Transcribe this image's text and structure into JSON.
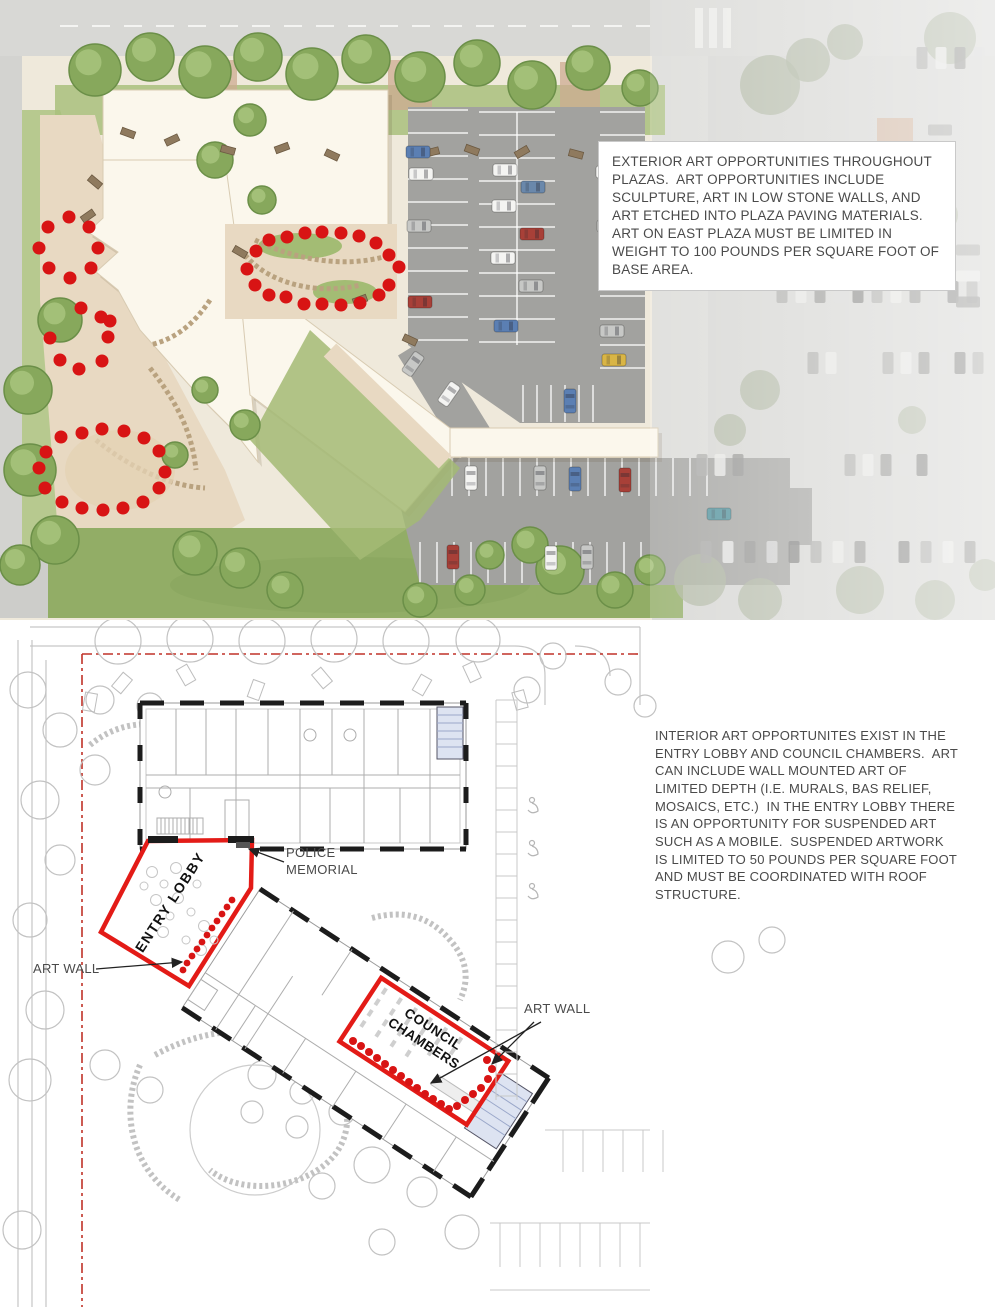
{
  "page": {
    "width": 995,
    "height": 1307
  },
  "colors": {
    "accent_red": "#e31b17",
    "dot_red": "#d81414",
    "building": "#fbf7ec",
    "parking": "#a2a29f",
    "cars": {
      "blue": "#5b7fb3",
      "blue2": "#6a88ab",
      "white": "#f4f4f2",
      "silver": "#c7c8c6",
      "red": "#a84038",
      "yellow": "#d9b545",
      "teal": "#4d8f99"
    }
  },
  "top_panel": {
    "note_text": "EXTERIOR ART OPPORTUNITIES THROUGHOUT PLAZAS.  ART OPPORTUNITIES INCLUDE SCULPTURE, ART IN LOW STONE WALLS, AND ART ETCHED INTO PLAZA PAVING MATERIALS.  ART ON EAST PLAZA MUST BE LIMITED IN WEIGHT TO 100 POUNDS PER SQUARE FOOT OF BASE AREA.",
    "art_dots": {
      "west_walk": [
        [
          69,
          217
        ],
        [
          48,
          227
        ],
        [
          89,
          227
        ],
        [
          39,
          248
        ],
        [
          98,
          248
        ],
        [
          49,
          268
        ],
        [
          91,
          268
        ],
        [
          70,
          278
        ],
        [
          81,
          308
        ],
        [
          101,
          317
        ],
        [
          61,
          437
        ],
        [
          46,
          452
        ],
        [
          39,
          468
        ],
        [
          45,
          488
        ],
        [
          62,
          502
        ]
      ],
      "courtyard": [
        [
          256,
          251
        ],
        [
          269,
          240
        ],
        [
          287,
          237
        ],
        [
          305,
          233
        ],
        [
          322,
          232
        ],
        [
          341,
          233
        ],
        [
          359,
          236
        ],
        [
          376,
          243
        ],
        [
          389,
          255
        ],
        [
          399,
          267
        ],
        [
          389,
          285
        ],
        [
          379,
          295
        ],
        [
          247,
          269
        ],
        [
          255,
          285
        ],
        [
          269,
          295
        ],
        [
          286,
          297
        ],
        [
          304,
          304
        ],
        [
          322,
          304
        ],
        [
          341,
          305
        ],
        [
          360,
          303
        ]
      ],
      "garden_ring": [
        [
          82,
          433
        ],
        [
          102,
          429
        ],
        [
          124,
          431
        ],
        [
          144,
          438
        ],
        [
          159,
          451
        ],
        [
          165,
          472
        ],
        [
          159,
          488
        ],
        [
          143,
          502
        ],
        [
          123,
          508
        ],
        [
          103,
          510
        ],
        [
          82,
          508
        ]
      ],
      "garden_arc": [
        [
          50,
          338
        ],
        [
          60,
          360
        ],
        [
          79,
          369
        ],
        [
          102,
          361
        ],
        [
          108,
          337
        ],
        [
          110,
          321
        ]
      ]
    },
    "trees": {
      "rendered": [
        [
          95,
          70,
          26
        ],
        [
          150,
          57,
          24
        ],
        [
          205,
          72,
          26
        ],
        [
          258,
          57,
          24
        ],
        [
          312,
          74,
          26
        ],
        [
          366,
          59,
          24
        ],
        [
          420,
          77,
          25
        ],
        [
          477,
          63,
          23
        ],
        [
          532,
          85,
          24
        ],
        [
          588,
          68,
          22
        ],
        [
          640,
          88,
          18
        ],
        [
          250,
          120,
          16
        ],
        [
          215,
          160,
          18
        ],
        [
          262,
          200,
          14
        ],
        [
          60,
          320,
          22
        ],
        [
          28,
          390,
          24
        ],
        [
          30,
          470,
          26
        ],
        [
          55,
          540,
          24
        ],
        [
          20,
          565,
          20
        ],
        [
          195,
          553,
          22
        ],
        [
          240,
          568,
          20
        ],
        [
          285,
          590,
          18
        ],
        [
          420,
          600,
          17
        ],
        [
          470,
          590,
          15
        ],
        [
          560,
          570,
          24
        ],
        [
          615,
          590,
          18
        ],
        [
          650,
          570,
          15
        ],
        [
          530,
          545,
          18
        ],
        [
          490,
          555,
          14
        ],
        [
          245,
          425,
          15
        ],
        [
          205,
          390,
          13
        ],
        [
          175,
          455,
          13
        ]
      ],
      "faded": [
        [
          770,
          85,
          30
        ],
        [
          808,
          60,
          22
        ],
        [
          845,
          42,
          18
        ],
        [
          950,
          38,
          26
        ],
        [
          900,
          185,
          22
        ],
        [
          940,
          215,
          18
        ],
        [
          855,
          240,
          14
        ],
        [
          760,
          390,
          20
        ],
        [
          730,
          430,
          16
        ],
        [
          912,
          420,
          14
        ],
        [
          700,
          580,
          26
        ],
        [
          760,
          600,
          22
        ],
        [
          860,
          590,
          24
        ],
        [
          935,
          600,
          20
        ],
        [
          985,
          575,
          16
        ]
      ]
    },
    "benches": [
      [
        128,
        133,
        20
      ],
      [
        172,
        140,
        -25
      ],
      [
        228,
        150,
        15
      ],
      [
        282,
        148,
        -20
      ],
      [
        332,
        155,
        25
      ],
      [
        432,
        152,
        -15
      ],
      [
        472,
        150,
        20
      ],
      [
        522,
        152,
        -30
      ],
      [
        576,
        154,
        15
      ],
      [
        620,
        150,
        -20
      ],
      [
        95,
        182,
        40
      ],
      [
        88,
        216,
        -35
      ],
      [
        240,
        252,
        30
      ],
      [
        360,
        300,
        -20
      ],
      [
        410,
        340,
        25
      ]
    ],
    "cars": [
      [
        418,
        152,
        90,
        "blue"
      ],
      [
        421,
        174,
        90,
        "white"
      ],
      [
        419,
        226,
        90,
        "silver"
      ],
      [
        420,
        302,
        90,
        "red"
      ],
      [
        505,
        170,
        90,
        "white"
      ],
      [
        533,
        187,
        90,
        "blue2"
      ],
      [
        504,
        206,
        90,
        "white"
      ],
      [
        532,
        234,
        90,
        "red"
      ],
      [
        503,
        258,
        90,
        "white"
      ],
      [
        531,
        286,
        90,
        "silver"
      ],
      [
        506,
        326,
        90,
        "blue"
      ],
      [
        608,
        172,
        90,
        "white"
      ],
      [
        609,
        226,
        90,
        "silver"
      ],
      [
        612,
        331,
        90,
        "silver"
      ],
      [
        614,
        360,
        90,
        "yellow"
      ],
      [
        570,
        401,
        0,
        "blue"
      ],
      [
        413,
        364,
        35,
        "silver"
      ],
      [
        449,
        394,
        35,
        "white"
      ],
      [
        471,
        478,
        0,
        "white"
      ],
      [
        540,
        478,
        0,
        "silver"
      ],
      [
        575,
        479,
        0,
        "blue"
      ],
      [
        625,
        480,
        0,
        "red"
      ],
      [
        719,
        514,
        90,
        "teal"
      ],
      [
        453,
        557,
        0,
        "red"
      ],
      [
        551,
        558,
        0,
        "white"
      ],
      [
        587,
        557,
        0,
        "silver"
      ]
    ],
    "faded_car_rows": [
      {
        "x": 782,
        "y": 292,
        "n": 11,
        "dx": 19,
        "dy": 0
      },
      {
        "x": 888,
        "y": 363,
        "n": 6,
        "dx": 18,
        "dy": 0
      },
      {
        "x": 922,
        "y": 58,
        "n": 4,
        "dx": 19,
        "dy": 0
      },
      {
        "x": 813,
        "y": 363,
        "n": 2,
        "dx": 18,
        "dy": 0
      },
      {
        "x": 702,
        "y": 465,
        "n": 3,
        "dx": 18,
        "dy": 0
      },
      {
        "x": 850,
        "y": 465,
        "n": 5,
        "dx": 18,
        "dy": 0
      },
      {
        "x": 706,
        "y": 552,
        "n": 13,
        "dx": 22,
        "dy": 0
      },
      {
        "x": 940,
        "y": 130,
        "n": 3,
        "dx": 0,
        "dy": 26
      },
      {
        "x": 968,
        "y": 250,
        "n": 4,
        "dx": 0,
        "dy": 26
      }
    ]
  },
  "bottom_panel": {
    "note_text": "INTERIOR ART OPPORTUNITES EXIST IN THE ENTRY LOBBY AND COUNCIL CHAMBERS.  ART CAN INCLUDE WALL MOUNTED ART OF LIMITED DEPTH (I.E. MURALS, BAS RELIEF, MOSAICS, ETC.)  IN THE ENTRY LOBBY THERE IS AN OPPORTUNITY FOR SUSPENDED ART SUCH AS A MOBILE.  SUSPENDED ARTWORK IS LIMITED TO 50 POUNDS PER SQUARE FOOT AND MUST BE COORDINATED WITH ROOF STRUCTURE.",
    "labels": {
      "entry_lobby": "ENTRY LOBBY",
      "council_chambers": "COUNCIL CHAMBERS",
      "police_memorial": "POLICE MEMORIAL",
      "art_wall": "ART WALL"
    },
    "art_dots": {
      "entry_lobby": [
        [
          232,
          900
        ],
        [
          227,
          907
        ],
        [
          222,
          914
        ],
        [
          217,
          921
        ],
        [
          212,
          928
        ],
        [
          207,
          935
        ],
        [
          202,
          942
        ],
        [
          197,
          949
        ],
        [
          192,
          956
        ],
        [
          187,
          963
        ],
        [
          183,
          970
        ]
      ],
      "council_chambers": [
        [
          353,
          1041
        ],
        [
          361,
          1046
        ],
        [
          369,
          1052
        ],
        [
          377,
          1058
        ],
        [
          385,
          1064
        ],
        [
          393,
          1070
        ],
        [
          401,
          1076
        ],
        [
          409,
          1082
        ],
        [
          417,
          1088
        ],
        [
          425,
          1094
        ],
        [
          433,
          1099
        ],
        [
          441,
          1104
        ],
        [
          449,
          1109
        ],
        [
          457,
          1106
        ],
        [
          465,
          1100
        ],
        [
          473,
          1094
        ],
        [
          481,
          1088
        ],
        [
          488,
          1079
        ],
        [
          492,
          1069
        ],
        [
          487,
          1060
        ]
      ]
    },
    "trees": [
      [
        118,
        641,
        23
      ],
      [
        190,
        639,
        23
      ],
      [
        262,
        641,
        23
      ],
      [
        334,
        639,
        23
      ],
      [
        406,
        641,
        23
      ],
      [
        478,
        640,
        22
      ],
      [
        553,
        656,
        13
      ],
      [
        527,
        690,
        13
      ],
      [
        618,
        682,
        13
      ],
      [
        100,
        700,
        14
      ],
      [
        150,
        706,
        13
      ],
      [
        60,
        730,
        17
      ],
      [
        95,
        770,
        15
      ],
      [
        40,
        800,
        19
      ],
      [
        170,
        790,
        12
      ],
      [
        60,
        860,
        15
      ],
      [
        30,
        920,
        17
      ],
      [
        45,
        1010,
        19
      ],
      [
        30,
        1080,
        21
      ],
      [
        105,
        1065,
        15
      ],
      [
        150,
        1090,
        13
      ],
      [
        262,
        1075,
        14
      ],
      [
        302,
        1092,
        12
      ],
      [
        342,
        1112,
        13
      ],
      [
        252,
        1112,
        11
      ],
      [
        297,
        1127,
        11
      ],
      [
        372,
        1165,
        18
      ],
      [
        422,
        1192,
        15
      ],
      [
        322,
        1186,
        13
      ],
      [
        462,
        1232,
        17
      ],
      [
        382,
        1242,
        13
      ],
      [
        728,
        957,
        16
      ],
      [
        772,
        940,
        13
      ],
      [
        645,
        706,
        11
      ],
      [
        28,
        690,
        18
      ],
      [
        22,
        1230,
        19
      ]
    ],
    "deck_benches": [
      [
        122,
        683,
        40
      ],
      [
        186,
        675,
        -30
      ],
      [
        256,
        690,
        20
      ],
      [
        322,
        678,
        -40
      ],
      [
        422,
        685,
        30
      ],
      [
        472,
        672,
        -25
      ],
      [
        90,
        702,
        10
      ],
      [
        520,
        700,
        -15
      ]
    ],
    "entry_furniture": [
      [
        152,
        872
      ],
      [
        164,
        884
      ],
      [
        178,
        898
      ],
      [
        191,
        912
      ],
      [
        204,
        926
      ],
      [
        170,
        916
      ],
      [
        156,
        900
      ],
      [
        186,
        940
      ],
      [
        201,
        950
      ],
      [
        214,
        940
      ],
      [
        163,
        932
      ],
      [
        144,
        886
      ],
      [
        176,
        868
      ],
      [
        197,
        884
      ]
    ],
    "stall_lines": [
      {
        "o": "h",
        "x": 496,
        "y": 700,
        "len": 21,
        "step": 22,
        "n": 19
      },
      {
        "o": "v",
        "x": 563,
        "y": 1130,
        "len": 42,
        "step": 20,
        "n": 6
      },
      {
        "o": "v",
        "x": 500,
        "y": 1223,
        "len": 44,
        "step": 20,
        "n": 8
      }
    ]
  }
}
